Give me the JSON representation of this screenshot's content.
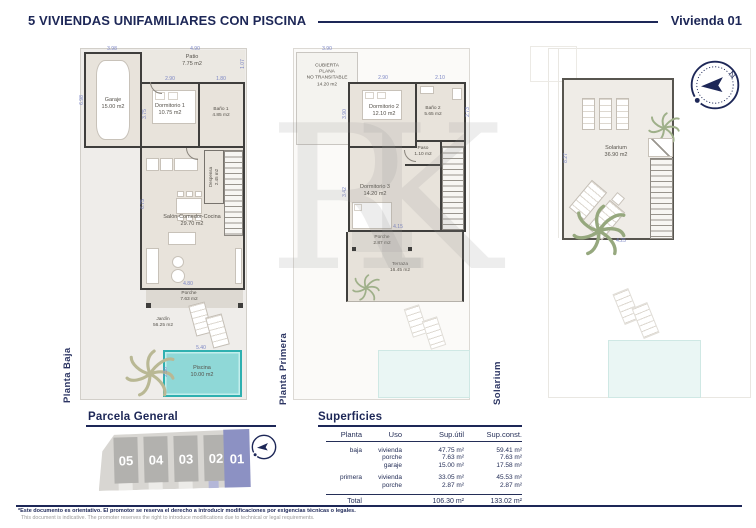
{
  "header": {
    "title": "5 VIVIENDAS UNIFAMILIARES CON PISCINA",
    "unit": "Vivienda 01"
  },
  "compass": {
    "north": "N"
  },
  "watermark": "RK",
  "plans": {
    "baja": {
      "side_label": "Planta Baja",
      "rooms": {
        "patio": {
          "name": "Patio",
          "area": "7.75 m2"
        },
        "garaje": {
          "name": "Garaje",
          "area": "15.00 m2"
        },
        "dorm1": {
          "name": "Dormitorio 1",
          "area": "10.75 m2"
        },
        "bano1": {
          "name": "Baño 1",
          "area": "4.85 m2"
        },
        "despensa": {
          "name": "Despensa",
          "area": "2.45 m2"
        },
        "salon": {
          "name": "Salón-Comedor-Cocina",
          "area": "29.70 m2"
        },
        "porche": {
          "name": "Porche",
          "area": "7.63 m2"
        },
        "jardin": {
          "name": "Jardín",
          "area": "56.25 m2"
        },
        "piscina": {
          "name": "Piscina",
          "area": "10.00 m2"
        }
      },
      "dims": {
        "d1": "3.98",
        "d2": "4.90",
        "d3": "1.07",
        "d4": "6.98",
        "d5": "2.90",
        "d6": "1.80",
        "d7": "3.75",
        "d8": "4.80",
        "d9": "6.75",
        "d10": "5.40",
        "d11": "2.50"
      }
    },
    "primera": {
      "side_label": "Planta Primera",
      "rooms": {
        "cubierta": {
          "l1": "CUBIERTA",
          "l2": "PLANA",
          "l3": "NO TRANSITABLE",
          "area": "14.20 m2"
        },
        "dorm2": {
          "name": "Dormitorio 2",
          "area": "12.10 m2"
        },
        "bano2": {
          "name": "Baño 2",
          "area": "5.65 m2"
        },
        "paso": {
          "name": "Paso",
          "area": "1.10 m2"
        },
        "dorm3": {
          "name": "Dormitorio 3",
          "area": "14.20 m2"
        },
        "porche": {
          "name": "Porche",
          "area": "2.87 m2"
        },
        "terraza": {
          "name": "Terraza",
          "area": "16.45 m2"
        }
      },
      "dims": {
        "d1": "3.90",
        "d2": "2.90",
        "d3": "2.10",
        "d4": "2.73",
        "d5": "3.90",
        "d6": "3.42",
        "d7": "4.15"
      }
    },
    "solarium": {
      "side_label": "Solarium",
      "rooms": {
        "solarium": {
          "name": "Solarium",
          "area": "36.90 m2"
        }
      },
      "dims": {
        "d1": "8.27",
        "d2": "4.25"
      }
    }
  },
  "parcela": {
    "title": "Parcela General",
    "units": [
      "05",
      "04",
      "03",
      "02",
      "01"
    ]
  },
  "superficies": {
    "title": "Superficies",
    "columns": [
      "Planta",
      "Uso",
      "Sup.útil",
      "Sup.const."
    ],
    "rows": [
      {
        "planta": "baja",
        "uso": "vivienda",
        "util": "47.75 m²",
        "const": "59.41 m²"
      },
      {
        "planta": "",
        "uso": "porche",
        "util": "7.63 m²",
        "const": "7.63 m²"
      },
      {
        "planta": "",
        "uso": "garaje",
        "util": "15.00 m²",
        "const": "17.58 m²"
      },
      {
        "planta": "primera",
        "uso": "vivienda",
        "util": "33.05 m²",
        "const": "45.53 m²"
      },
      {
        "planta": "",
        "uso": "porche",
        "util": "2.87 m²",
        "const": "2.87 m²"
      }
    ],
    "total_label": "Total",
    "total_util": "106.30 m²",
    "total_const": "133.02 m²"
  },
  "footer": {
    "es": "*Este documento es orientativo. El promotor se reserva el derecho a introducir modificaciones por exigencias técnicas o legales.",
    "en": "This document is indicative. The promoter reserves the right to introduce modifications due to technical or legal requirements."
  }
}
